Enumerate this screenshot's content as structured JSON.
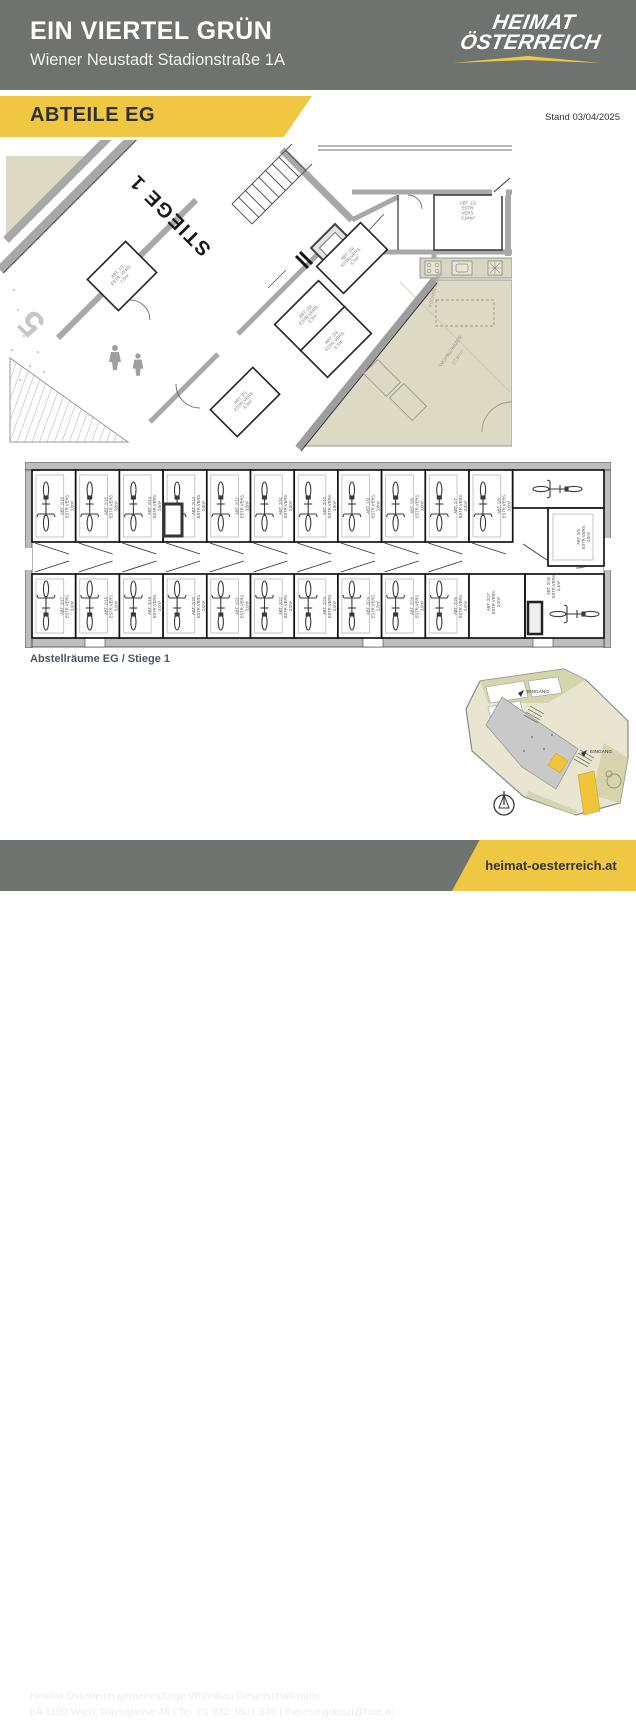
{
  "header": {
    "title": "EIN VIERTEL GRÜN",
    "subtitle": "Wiener Neustadt Stadionstraße 1A",
    "logo": {
      "line1": "HEIMAT",
      "line2": "ÖSTERREICH"
    }
  },
  "section_band": {
    "label": "ABTEILE EG",
    "stand": "Stand 03/04/2025"
  },
  "colors": {
    "accent_yellow": "#efc743",
    "header_gray": "#6f7370",
    "apartment_beige": "#dcd9c4"
  },
  "main_plan": {
    "stiege_label": "STIEGE 1",
    "garage_number": "5",
    "rooms": [
      {
        "id": "ABT. 1/1",
        "finish": "ESTR. VERS.",
        "area": "7,5m²"
      },
      {
        "id": "ABT. 1/2",
        "finish": "ESTR. VERS.",
        "area": "3,04m²"
      },
      {
        "id": "ABT. 2/1",
        "finish": "ESTR.VERS.",
        "area": "3,3m²"
      },
      {
        "id": "ABT. 2/2",
        "finish": "ESTR.VERS.",
        "area": "3,3m²"
      },
      {
        "id": "ABT. 2/3",
        "finish": "ESTR.VERS.",
        "area": "3,3m²"
      },
      {
        "id": "ABT. 2/4",
        "finish": "ESTR.VERS.",
        "area": "3,3m²"
      }
    ],
    "apartment": {
      "livingroom": "WOHNZIMMER",
      "livingroom_area": "27,87m²",
      "kitchen": "KOCHEN ESSEN"
    }
  },
  "strip_plan": {
    "top_row": [
      {
        "id": "ABT. 2/16",
        "finish": "ESTR.VERS.",
        "area": "3,8m²"
      },
      {
        "id": "ABT. 2/15",
        "finish": "ESTR.VERS.",
        "area": "3,8m²"
      },
      {
        "id": "ABT. 2/14",
        "finish": "ESTR.VERS.",
        "area": "3,8m²"
      },
      {
        "id": "ABT. 2/13",
        "finish": "ESTR.VERS.",
        "area": "3,8m²"
      },
      {
        "id": "ABT. 2/12",
        "finish": "ESTR.VERS.",
        "area": "3,8m²"
      },
      {
        "id": "ABT. 2/11",
        "finish": "ESTR.VERS.",
        "area": "3,8m²"
      },
      {
        "id": "ABT. 2/10",
        "finish": "ESTR.VERS.",
        "area": "3,8m²"
      },
      {
        "id": "ABT. 2/9",
        "finish": "ESTR.VERS.",
        "area": "3,8m²"
      },
      {
        "id": "ABT. 2/8",
        "finish": "ESTR.VERS.",
        "area": "3,8m²"
      },
      {
        "id": "ABT. 2/7",
        "finish": "ESTR.VERS.",
        "area": "3,8m²"
      },
      {
        "id": "ABT. 2/6",
        "finish": "ESTR.VERS.",
        "area": "3,8m²"
      }
    ],
    "top_end": {
      "id": "ABT. 2/5",
      "finish": "ESTR.VERS.",
      "area": "3,8m²"
    },
    "bottom_row": [
      {
        "id": "ABT. 2/17",
        "finish": "ESTR.VERS.",
        "area": "3,0m²"
      },
      {
        "id": "ABT. 2/18",
        "finish": "ESTR.VERS.",
        "area": "3,0m²"
      },
      {
        "id": "ABT. 2/19",
        "finish": "ESTR.VERS.",
        "area": "3,0m²"
      },
      {
        "id": "ABT. 2/20",
        "finish": "ESTR.VERS.",
        "area": "3,0m²"
      },
      {
        "id": "ABT. 2/21",
        "finish": "ESTR.VERS.",
        "area": "3,0m²"
      },
      {
        "id": "ABT. 2/22",
        "finish": "ESTR.VERS.",
        "area": "3,0m²"
      },
      {
        "id": "ABT. 2/23",
        "finish": "ESTR.VERS.",
        "area": "3,0m²"
      },
      {
        "id": "ABT. 2/24",
        "finish": "ESTR.VERS.",
        "area": "3,0m²"
      },
      {
        "id": "ABT. 2/25",
        "finish": "ESTR.VERS.",
        "area": "3,0m²"
      },
      {
        "id": "ABT. 2/26",
        "finish": "ESTR.VERS.",
        "area": "3,0m²"
      }
    ],
    "bottom_end_rooms": [
      {
        "id": "ABT. 2/27",
        "finish": "ESTR.VERS.",
        "area": "3,0m²"
      },
      {
        "id": "ABT. 2/28",
        "finish": "ESTR.VERS.",
        "area": "3,3m²"
      }
    ]
  },
  "caption": "Abstellräume EG / Stiege 1",
  "overview_map": {
    "entrance_top": "EINGANG",
    "entrance_right": "EINGANG"
  },
  "footer": {
    "line1": "Heimat Österreich gemeinnützige Wohnbau Gesellschaft mbH",
    "line2": "pA 1100 Wien, Davidgasse 48  |  Tel. 01 982 3601 645  |  theresa.guenzl@hoe.at",
    "website": "heimat-oesterreich.at"
  }
}
